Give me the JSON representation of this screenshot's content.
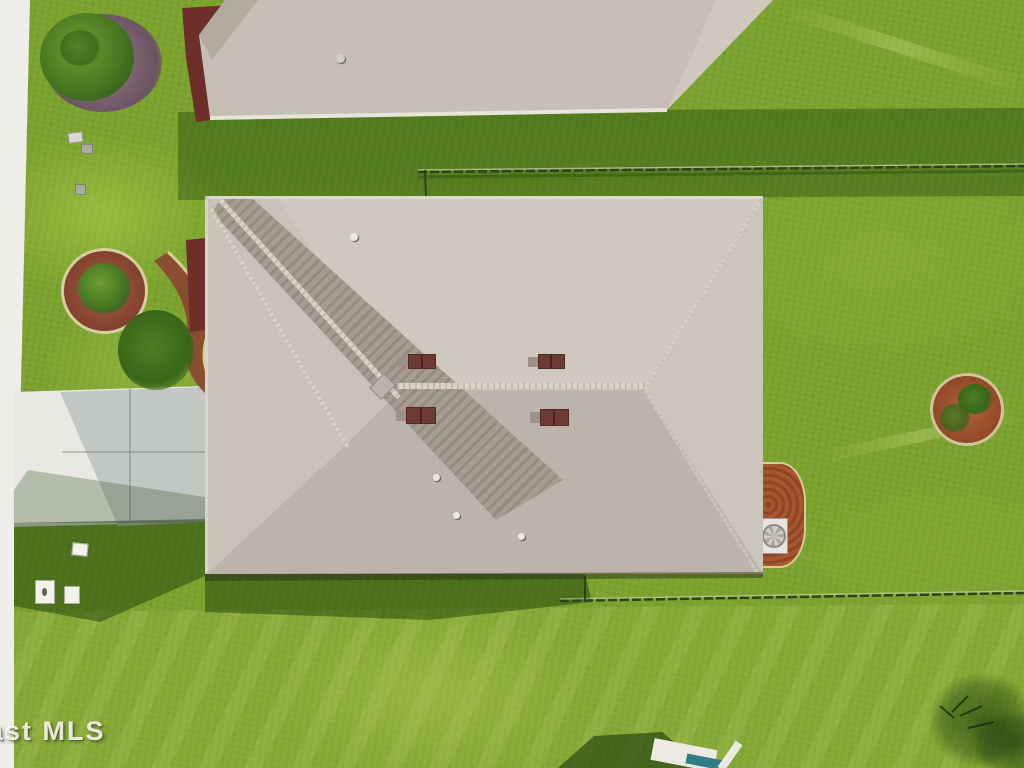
{
  "scene": {
    "type": "aerial-drone-photo",
    "description": "Top-down aerial view of a single-family house with a light gray shingle hip roof, surrounded by green lawn, a concrete driveway at left, chain-link fences, circular mulch garden beds, and a neighboring roof at top",
    "objects": {
      "neighbor_roof": "partial hip roof of neighboring house at top edge",
      "main_roof": "large rectangular hip roof with diagonal shaded facet and ridge caps",
      "roof_vents": "four dark reddish-brown box vents near the central ridge",
      "driveway": "white concrete driveway on left with cast house shadow",
      "sidewalk": "white sidewalk/road edge strip along left border",
      "garden_bed_left": "circular red-mulch bed with shrub near driveway",
      "garden_bed_right": "circular orange-mulch planter in right yard",
      "front_shrub": "palm shrub on purple-gray mulch at top-left",
      "curved_bed": "curved red mulch bed with bush at house front-left",
      "side_mulch_ac": "orange mulch pad with white AC unit on right side of house",
      "fence_top": "chain-link fence line across upper yard",
      "fence_back": "chain-link fence line behind the house",
      "utility_boxes": "small gray and white utility boxes in the lawn",
      "bottom_structure": "partially visible structure with white and teal objects at bottom edge",
      "tree_shadow": "dark tree/bush shadow at bottom-right corner"
    }
  },
  "watermark": {
    "text": "ast MLS"
  },
  "colors": {
    "lawn_base": "#7da32f",
    "lawn_bright": "#a3c24d",
    "lawn_shadow": "#2a4a10",
    "roof_shingle": "#c9c2b8",
    "roof_facet_dark": "#a69c92",
    "roof_ridge_cap": "#dad3c8",
    "vent_brown": "#6d3b33",
    "driveway_concrete": "#e9e8e3",
    "driveway_shadow": "#c3c7c3",
    "sidewalk": "#eeede9",
    "mulch_red": "#83422f",
    "mulch_orange": "#a8562e",
    "mulch_purple": "#7d6472",
    "ac_unit_white": "#e6e4de",
    "teal_object": "#2f7d85",
    "fence_dark": "#2e4418"
  }
}
